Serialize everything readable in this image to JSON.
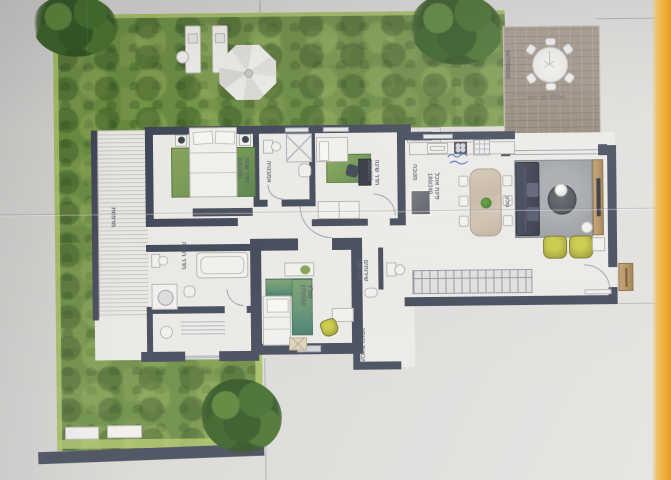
{
  "meta": {
    "kind": "architectural floor plan photo",
    "language": "Hebrew"
  },
  "deck": {
    "label": "מרפסת עץ",
    "permit_note": "הצללה לפי היתר"
  },
  "rooms": {
    "master_bedroom": {
      "label": "חדר שינה",
      "dims": "305/280"
    },
    "bathroom": {
      "label": "אמבטיה"
    },
    "bedroom2": {
      "label": "חדר שינה",
      "dims": "280/270"
    },
    "safe_room": {
      "label": "ממ\"ד",
      "dims": "270/260"
    },
    "shower_room": {
      "label": "חדר רחצה"
    },
    "west_porch": {
      "label": "מרפסת"
    },
    "wc": {
      "label": "שירותים",
      "dims": "130/165"
    },
    "entry_hall": {
      "label": "מבואת כניסה"
    },
    "kitchen": {
      "label": "מטבח"
    },
    "dining": {
      "label": "פינת אוכל",
      "dims": "180/240"
    },
    "living": {
      "label": "סלון"
    }
  },
  "colors": {
    "wall": "#3e4556",
    "grass": "#678a3c",
    "deck_wood": "#9a8a7a",
    "accent_olive": "#a8a72f",
    "paper_edge": "#f0ad32"
  }
}
